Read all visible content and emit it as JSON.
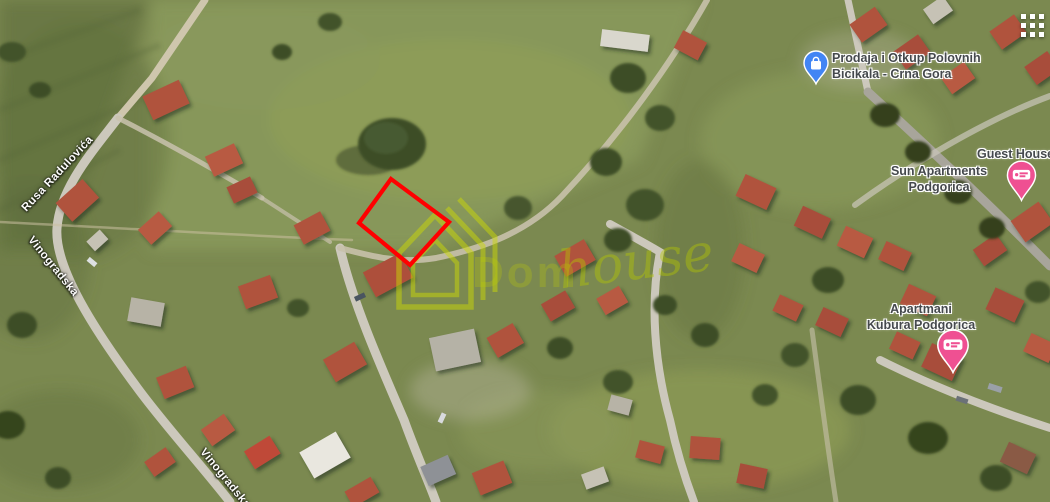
{
  "map": {
    "place_labels": {
      "bike_shop": {
        "line1": "Prodaja i Otkup Polovnih",
        "line2": "Bicikala - Crna Gora",
        "pin_color": "#4285f4"
      },
      "guest_house": {
        "line1": "Guest House"
      },
      "sun_apartments": {
        "line1": "Sun Apartments",
        "line2": "Podgorica",
        "pin_color": "#ef5092"
      },
      "kubura": {
        "line1": "Apartmani",
        "line2": "Kubura Podgorica",
        "pin_color": "#ef5092"
      }
    },
    "street_labels": {
      "rusa": "Rusa Radulovića",
      "vinogradska_upper": "Vinogradska",
      "vinogradska_lower": "Vinogradska"
    },
    "overlay": {
      "plot_outline_points": "391,179 449,222 410,265 359,223",
      "stroke_color": "#ff0000"
    },
    "watermark": {
      "brand_main": "Dom",
      "brand_script": "house",
      "color": "#c3d000"
    },
    "icons": {
      "apps_grid": "3x3-white-dots-grid",
      "bike_shop_pin": "blue-shopping-bag-pin",
      "lodging_pin": "pink-price-tag-pin"
    }
  }
}
